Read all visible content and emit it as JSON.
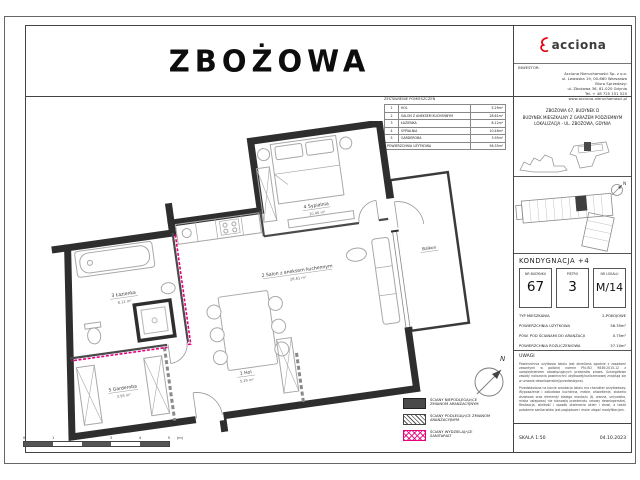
{
  "header": {
    "logo_text": "ZBOŻOWA",
    "brand": {
      "name": "acciona"
    },
    "investor": {
      "label": "INWESTOR:",
      "lines": [
        "Acciona Nieruchomości Sp. z o.o.",
        "ul. Lwowska 19, 00-660 Warszawa",
        "Biuro Sprzedaży:",
        "ul. Zbożowa 36, 81-020 Gdynia",
        "Tel. + 48 725 151 520",
        "www.acciona-nieruchomosci.pl"
      ]
    }
  },
  "project": {
    "lines": [
      "ZBOŻOWA 67, BUDYNEK D",
      "BUDYNEK MIESZKALNY Z GARAŻEM PODZIEMNYM",
      "LOKALIZACJA - UL. ZBOŻOWA, GDYNIA"
    ]
  },
  "rooms_table": {
    "title": "ZESTAWIENIE POMIESZCZEŃ",
    "rows": [
      {
        "no": "1",
        "name": "HOL",
        "area": "5.29m²"
      },
      {
        "no": "2",
        "name": "SALON Z ANEKSEM KUCHENNYM",
        "area": "28.61m²"
      },
      {
        "no": "3",
        "name": "ŁAZIENKA",
        "area": "8.12m²"
      },
      {
        "no": "4",
        "name": "SYPIALNIA",
        "area": "10.46m²"
      },
      {
        "no": "5",
        "name": "GARDEROBA",
        "area": "3.95m²"
      }
    ],
    "footer": {
      "label": "POWIERZCHNIA UŻYTKOWA",
      "value": "56.35m²"
    }
  },
  "plan": {
    "rooms": [
      {
        "label": "1 Hol",
        "area": "5.29 m²"
      },
      {
        "label": "2 Salon z aneksem kuchennym",
        "area": "28.61 m²"
      },
      {
        "label": "3 Łazienka",
        "area": "8.12 m²"
      },
      {
        "label": "4 Sypialnia",
        "area": "10.46 m²"
      },
      {
        "label": "5 Garderoba",
        "area": "3.95 m²"
      }
    ],
    "balcony_label": "Balkon"
  },
  "legend": {
    "items": [
      {
        "label": "ŚCIANY NIEPODLEGAJĄCE ZMIANOM ARANŻACYJNYM",
        "type": "solid"
      },
      {
        "label": "ŚCIANY PODLEGAJĄCE ZMIANOM ARANŻACYJNYM",
        "type": "hatch"
      },
      {
        "label": "ŚCIANY WYDZIELAJĄCE SANITARIAT",
        "type": "pink"
      }
    ]
  },
  "scale_bar": {
    "ticks": [
      "0",
      "1",
      "2",
      "3",
      "4",
      "5"
    ],
    "unit": "(m)"
  },
  "compass": {
    "label": "N"
  },
  "unit_info": {
    "header": "KONDYGNACJA +4",
    "boxes": [
      {
        "label": "NR BUDYNKU",
        "value": "67"
      },
      {
        "label": "PIĘTRO",
        "value": "3"
      },
      {
        "label": "NR LOKALU",
        "value": "M/14"
      }
    ],
    "rows": [
      {
        "label": "TYP MIESZKANIA",
        "value": "2-POKOJOWE"
      },
      {
        "label": "POWIERZCHNIA UŻYTKOWA",
        "value": "56.35m²"
      },
      {
        "label": "POW. POD ŚCIANAMI DO ARANŻACJI",
        "value": "0.75m²"
      },
      {
        "label": "POWIERZCHNIA ROZLICZENIOWA",
        "value": "57.10m²"
      }
    ]
  },
  "notes": {
    "title": "UWAGI",
    "paragraphs": [
      "Powierzchnia użytkowa lokalu jest określona zgodnie z zasadami zawartymi w polskiej normie PN-ISO 9836:2015-12 z uwzględnieniem obowiązujących przepisów prawa. Szczegółowe zasady naliczania powierzchni użytkowej/rozliczeniowej znajdują się w umowie deweloperskiej/przedwstępnej.",
      "Przedstawiona na karcie aranżacja lokalu ma charakter przykładowy. Wyposażenie i zabudowa kuchenna, meble, oświetlenie, stolarka drzwiowa oraz elementy białego montażu (tj. wanna, umywalka, miska ustępowa) nie stanowią przedmiotu umowy deweloperskiej. Realizacja, wielkość i sposób otwierania okien i drzwi, a także położenie sanitariatów jest poglądowe i może ulegać modyfikacjom."
    ]
  },
  "panel_footer": {
    "scale": "SKALA 1:50",
    "date": "04.10.2023"
  },
  "colors": {
    "wall": "#2e2e2e",
    "sanitary_pink": "#e6007e",
    "acciona_red": "#e30613"
  }
}
